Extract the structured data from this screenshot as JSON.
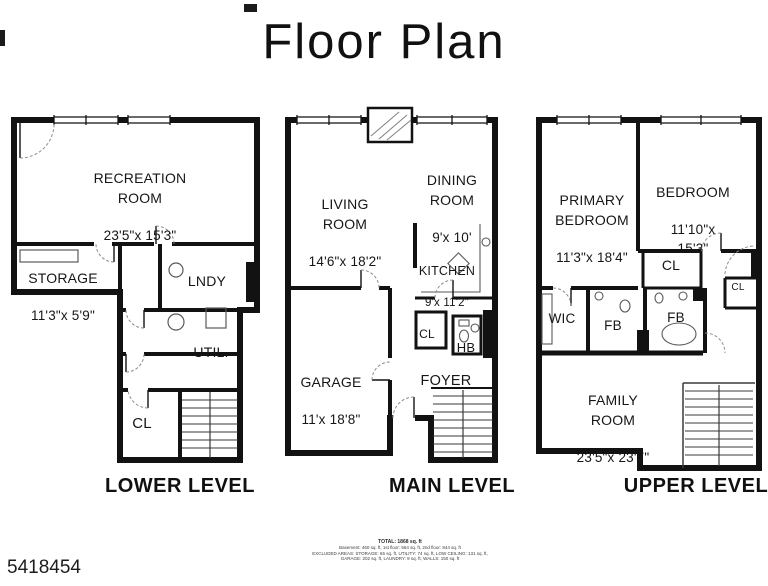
{
  "title": "Floor Plan",
  "watermark": "5418454",
  "colors": {
    "wall": "#121212",
    "text": "#161616",
    "background": "#ffffff"
  },
  "footer": {
    "line1": "TOTAL: 1868 sq. ft",
    "line2": "Basement: 460 sq. ft, 1st floor: 564 sq. ft, 2nd floor: 844 sq. ft",
    "line3": "EXCLUDED AREAS: STORAGE: 65 sq. ft, UTILITY: 74 sq. ft, LOW CEILING: 131 sq. ft,",
    "line4": "GARAGE: 202 sq. ft, LAUNDRY: 9 sq. ft, WALLS: 150 sq. ft"
  },
  "levels": [
    {
      "label": "LOWER LEVEL",
      "rooms": {
        "recreation": {
          "name": "RECREATION\nROOM",
          "dims": "23'5\"x 15'3\""
        },
        "storage": {
          "name": "STORAGE",
          "dims": "11'3\"x 5'9\""
        },
        "laundry": {
          "name": "LNDY"
        },
        "utility": {
          "name": "UTIL."
        },
        "closet": {
          "name": "CL"
        }
      }
    },
    {
      "label": "MAIN LEVEL",
      "rooms": {
        "living": {
          "name": "LIVING\nROOM",
          "dims": "14'6\"x 18'2\""
        },
        "dining": {
          "name": "DINING\nROOM",
          "dims": "9'x 10'"
        },
        "kitchen": {
          "name": "KITCHEN",
          "dims": "9'x 11'2\""
        },
        "garage": {
          "name": "GARAGE",
          "dims": "11'x 18'8\""
        },
        "closet": {
          "name": "CL"
        },
        "half_bath": {
          "name": "HB"
        },
        "foyer": {
          "name": "FOYER"
        }
      }
    },
    {
      "label": "UPPER LEVEL",
      "rooms": {
        "primary": {
          "name": "PRIMARY\nBEDROOM",
          "dims": "11'3\"x 18'4\""
        },
        "bedroom": {
          "name": "BEDROOM",
          "dims": "11'10\"x 15'3\""
        },
        "closet1": {
          "name": "CL"
        },
        "wic": {
          "name": "WIC"
        },
        "full_bath1": {
          "name": "FB"
        },
        "full_bath2": {
          "name": "FB"
        },
        "closet2": {
          "name": "CL"
        },
        "family": {
          "name": "FAMILY\nROOM",
          "dims": "23'5\"x 23'7\""
        }
      }
    }
  ]
}
